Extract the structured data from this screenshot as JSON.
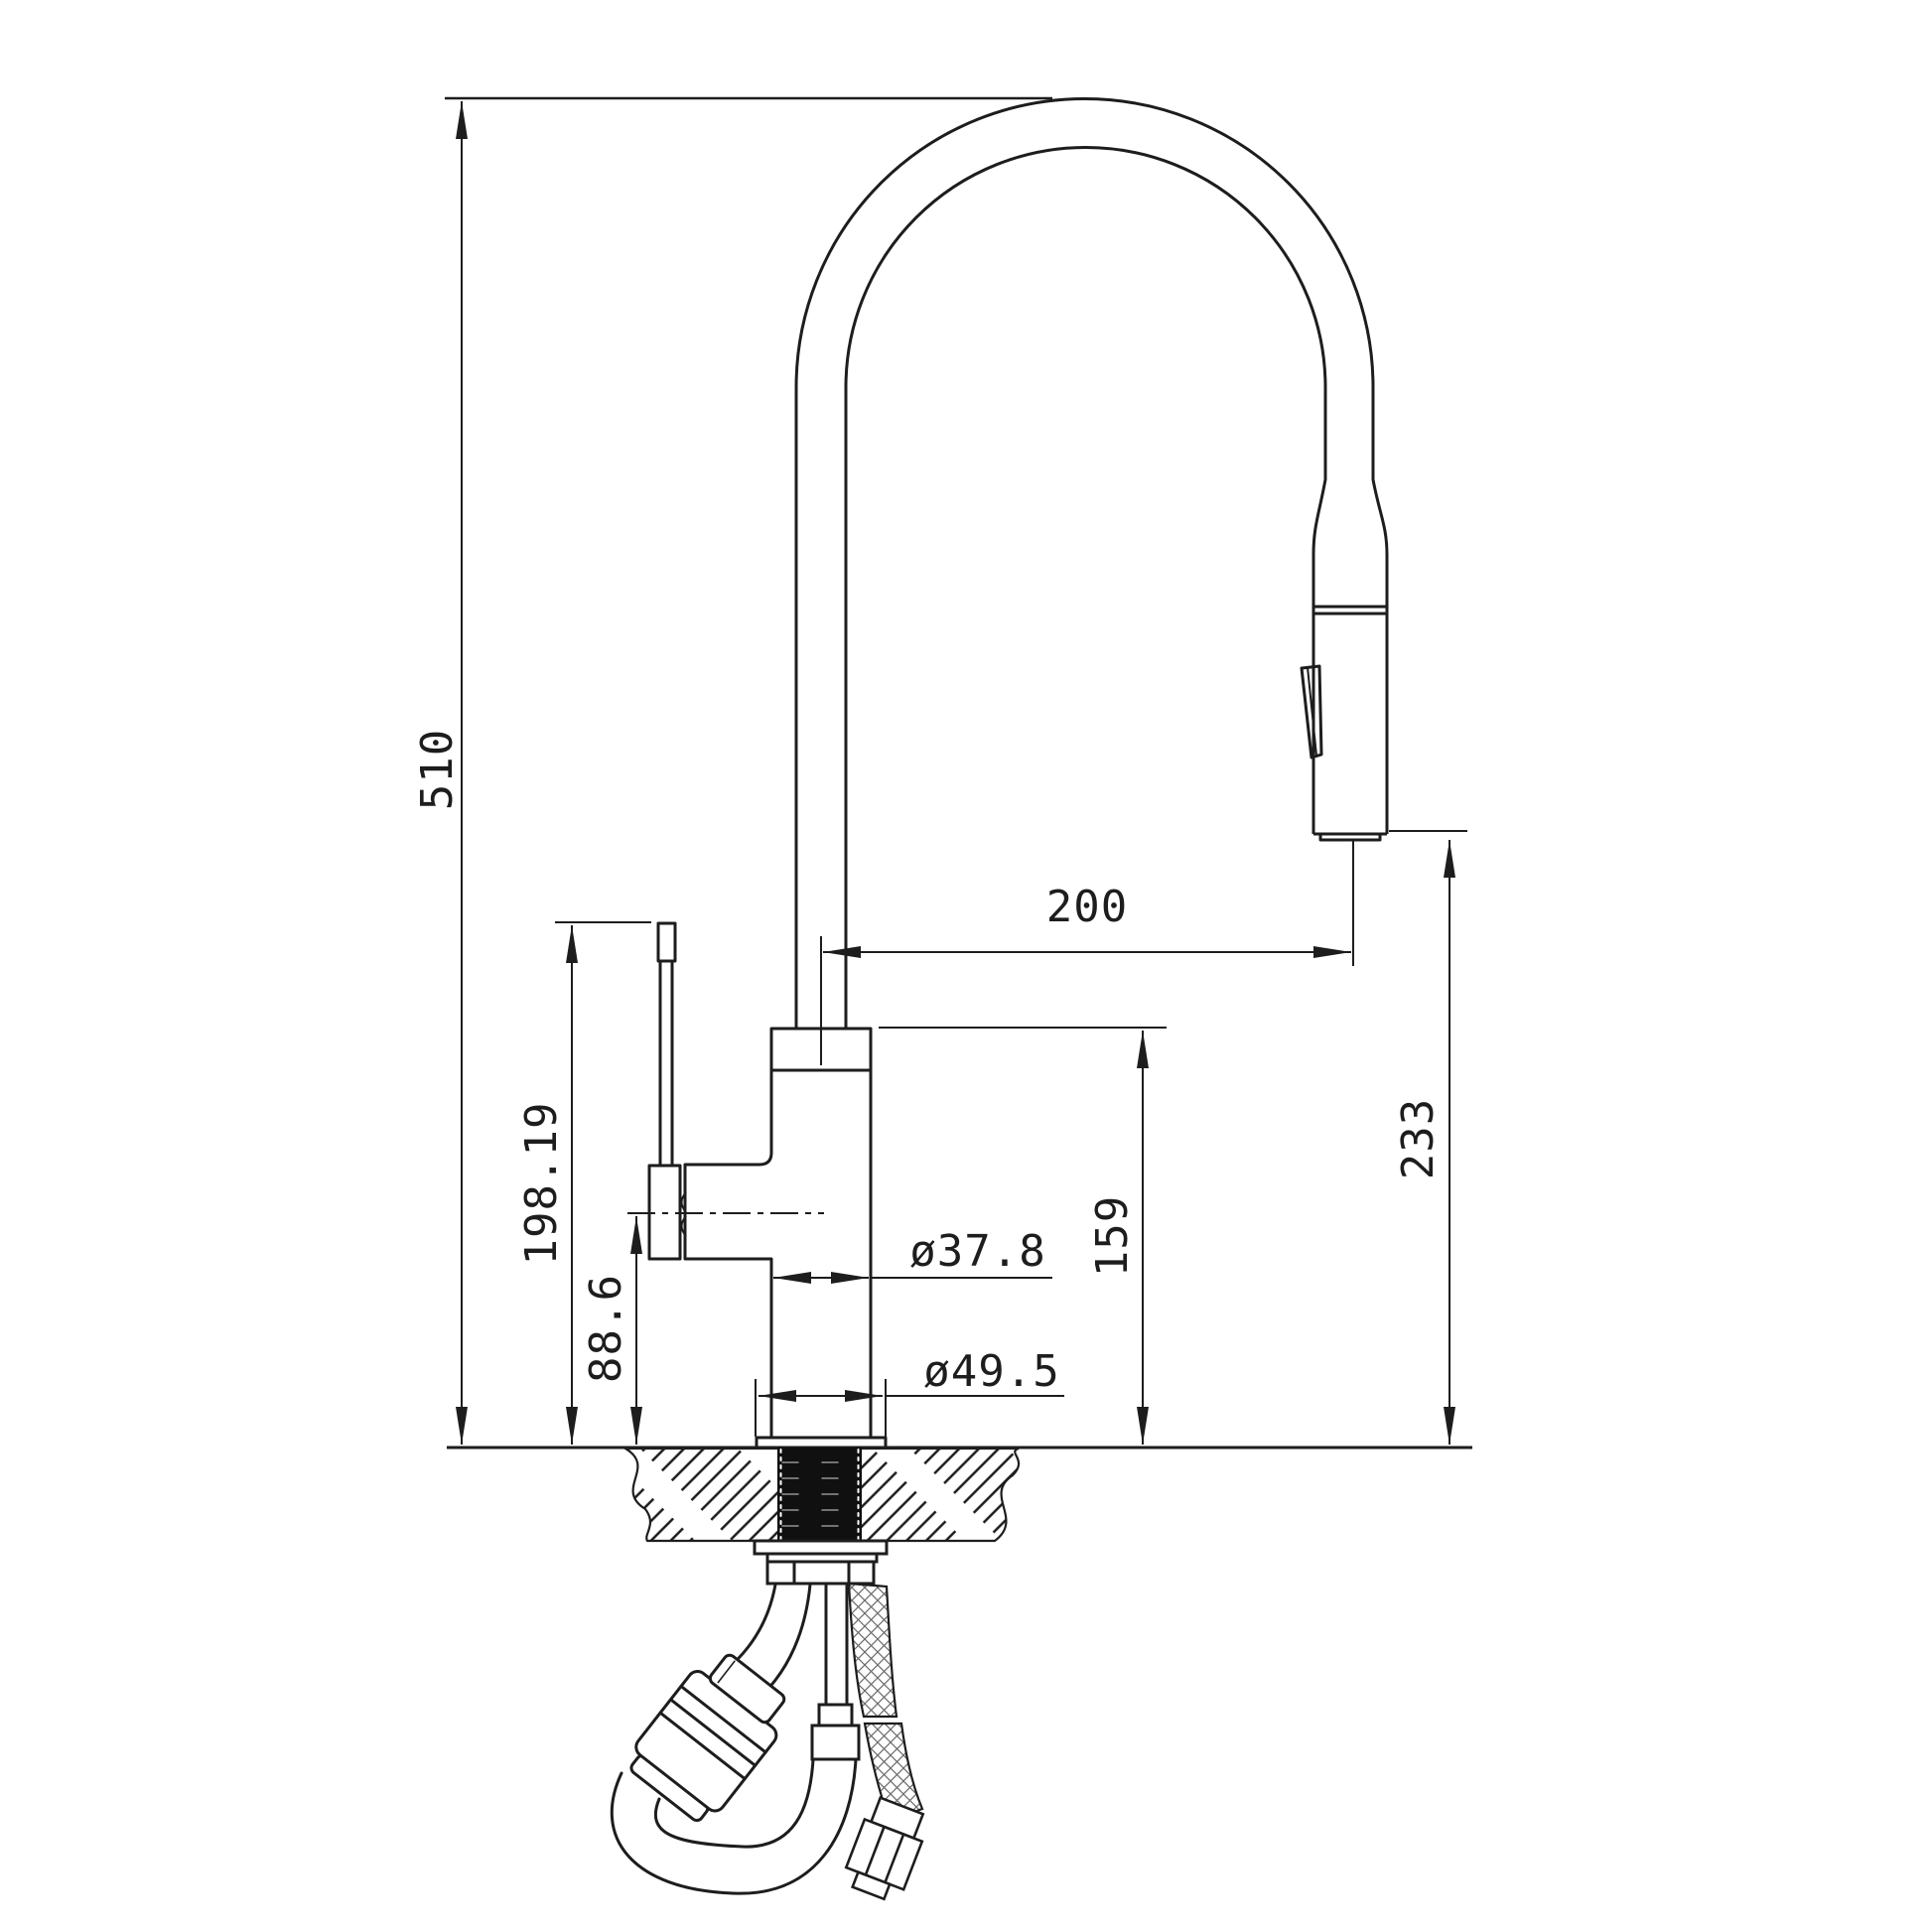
{
  "drawing": {
    "subject": "pull-down kitchen faucet side elevation installation drawing",
    "units": "mm",
    "line_color": "#1d1d1d",
    "background": "#ffffff",
    "dimensions": {
      "overall_height": "510",
      "spout_reach": "200",
      "spray_head_to_counter": "233",
      "handle_top_to_counter": "198.19",
      "body_top_to_counter": "159",
      "handle_center_to_counter": "88.6",
      "body_diameter": "ø37.8",
      "base_diameter": "ø49.5"
    }
  }
}
